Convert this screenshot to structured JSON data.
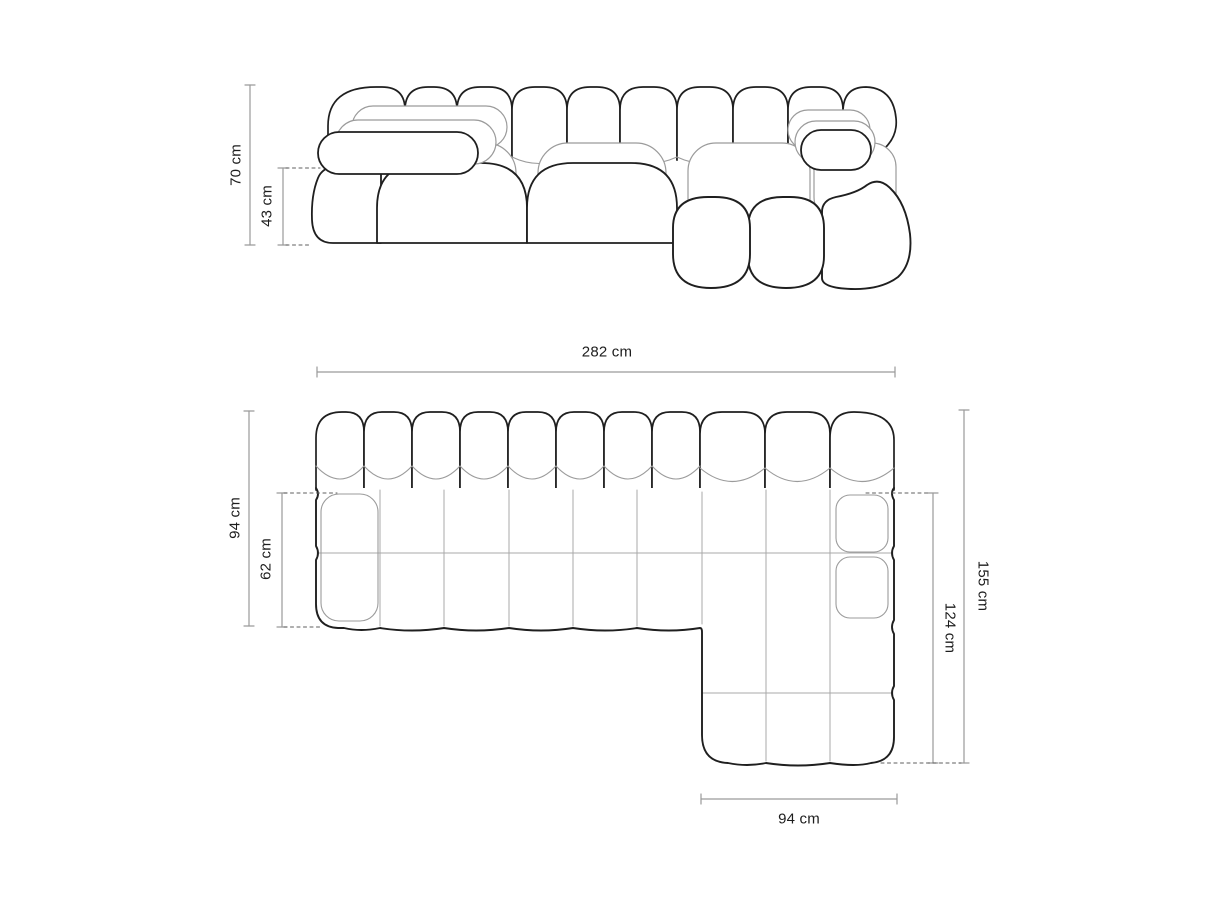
{
  "diagram": {
    "title": "sofa-dimension-diagram",
    "front_view": {
      "height": "70 cm",
      "seat_height": "43 cm"
    },
    "plan_view": {
      "total_width": "282 cm",
      "depth_left": "94 cm",
      "seat_depth": "62 cm",
      "depth_right": "155 cm",
      "chaise_depth": "124 cm",
      "chaise_width": "94 cm"
    },
    "colors": {
      "background": "#ffffff",
      "outline": "#1f1f1f",
      "seam": "#9b9b9b",
      "grid_line": "#a8a8a8",
      "dimension_line": "#9a9a9a",
      "tick": "#8f8f8f",
      "dotted_line": "#5f5f5f",
      "label_text": "#1d1d1d"
    }
  }
}
